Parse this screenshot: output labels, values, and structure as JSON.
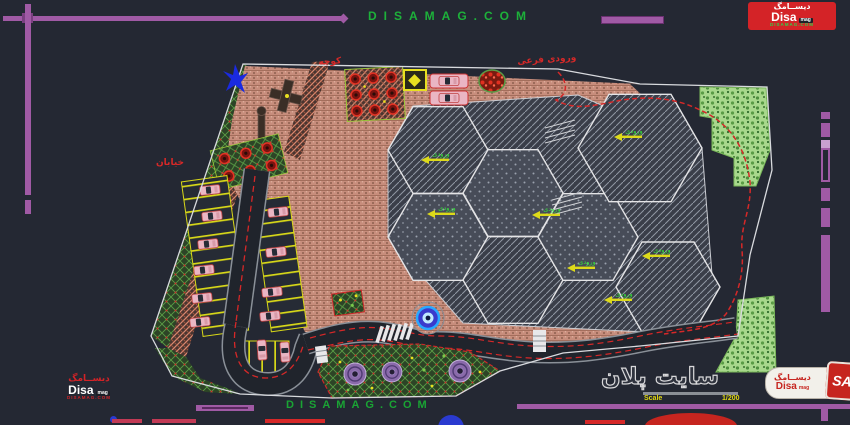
{
  "watermark": {
    "top": "DISAMAG.COM",
    "bottom": "DISAMAG.COM"
  },
  "logo_top_right": {
    "persian": "دیســامگ",
    "name": "Disa",
    "suffix": "mag",
    "site": "DISAMAG.COM"
  },
  "logo_bottom_left": {
    "persian": "دیســامگ",
    "name": "Disa",
    "suffix": "mag",
    "site": "DISAMAG.COM"
  },
  "logo_bottom_right": {
    "persian": "دیســامگ",
    "name": "Disa",
    "suffix": "mag",
    "monogram": "SA"
  },
  "title_block": {
    "title": "سایت پلان",
    "scale_label": "Scale",
    "scale_value": "1/200"
  },
  "plan_labels": {
    "alley": "کوچه",
    "secondary_entrance": "ورودی فرعی",
    "street": "خیابان",
    "hex_label": "ورودی"
  },
  "colors": {
    "background": "#242833",
    "frame_purple": "#a05aa5",
    "watermark_green": "#1db13a",
    "path_red": "#d62828",
    "logo_red": "#d42327",
    "plaza_salmon": "#c78d7c",
    "vegetation_green": "#a8d88c",
    "fountain_blue": "#29a8ff"
  }
}
